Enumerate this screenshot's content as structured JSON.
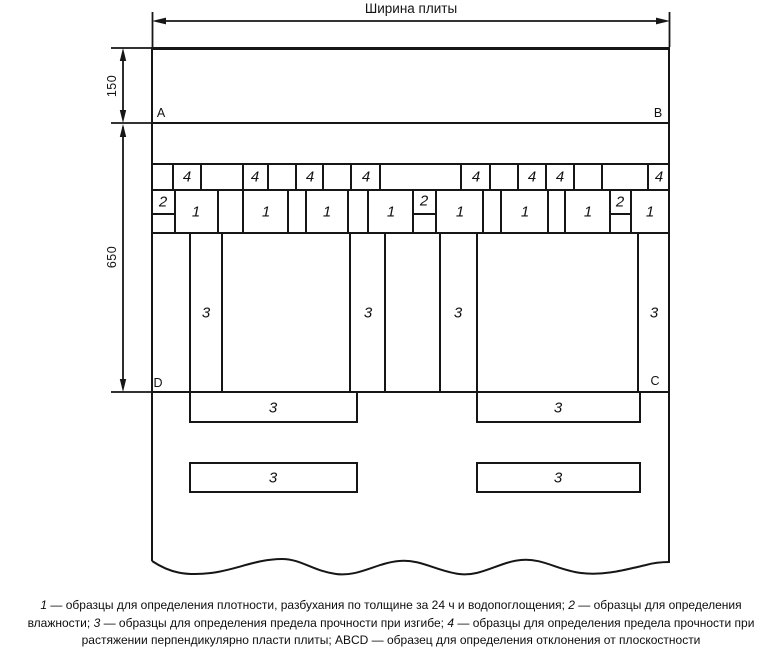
{
  "figure": {
    "width_label": "Ширина плиты",
    "dims": {
      "d150": "150",
      "d650": "650"
    },
    "corners": {
      "a": "A",
      "b": "B",
      "c": "C",
      "d": "D"
    },
    "labels": {
      "s1": "1",
      "s2": "2",
      "s3": "3",
      "s4": "4"
    }
  },
  "caption": {
    "lines": [
      [
        {
          "t": "1",
          "i": true
        },
        {
          "t": " — образцы для определения плотности, разбухания по толщине за 24 ч и водопоглощения; "
        },
        {
          "t": "2",
          "i": true
        },
        {
          "t": " — образцы для определения"
        }
      ],
      [
        {
          "t": "влажности; "
        },
        {
          "t": "3",
          "i": true
        },
        {
          "t": " — образцы для определения предела прочности при изгибе; "
        },
        {
          "t": "4",
          "i": true
        },
        {
          "t": " — образцы для определения предела прочности при"
        }
      ],
      [
        {
          "t": "растяжении перпендикулярно пласти плиты; ABCD — образец для определения отклонения от плоскостности"
        }
      ]
    ]
  }
}
